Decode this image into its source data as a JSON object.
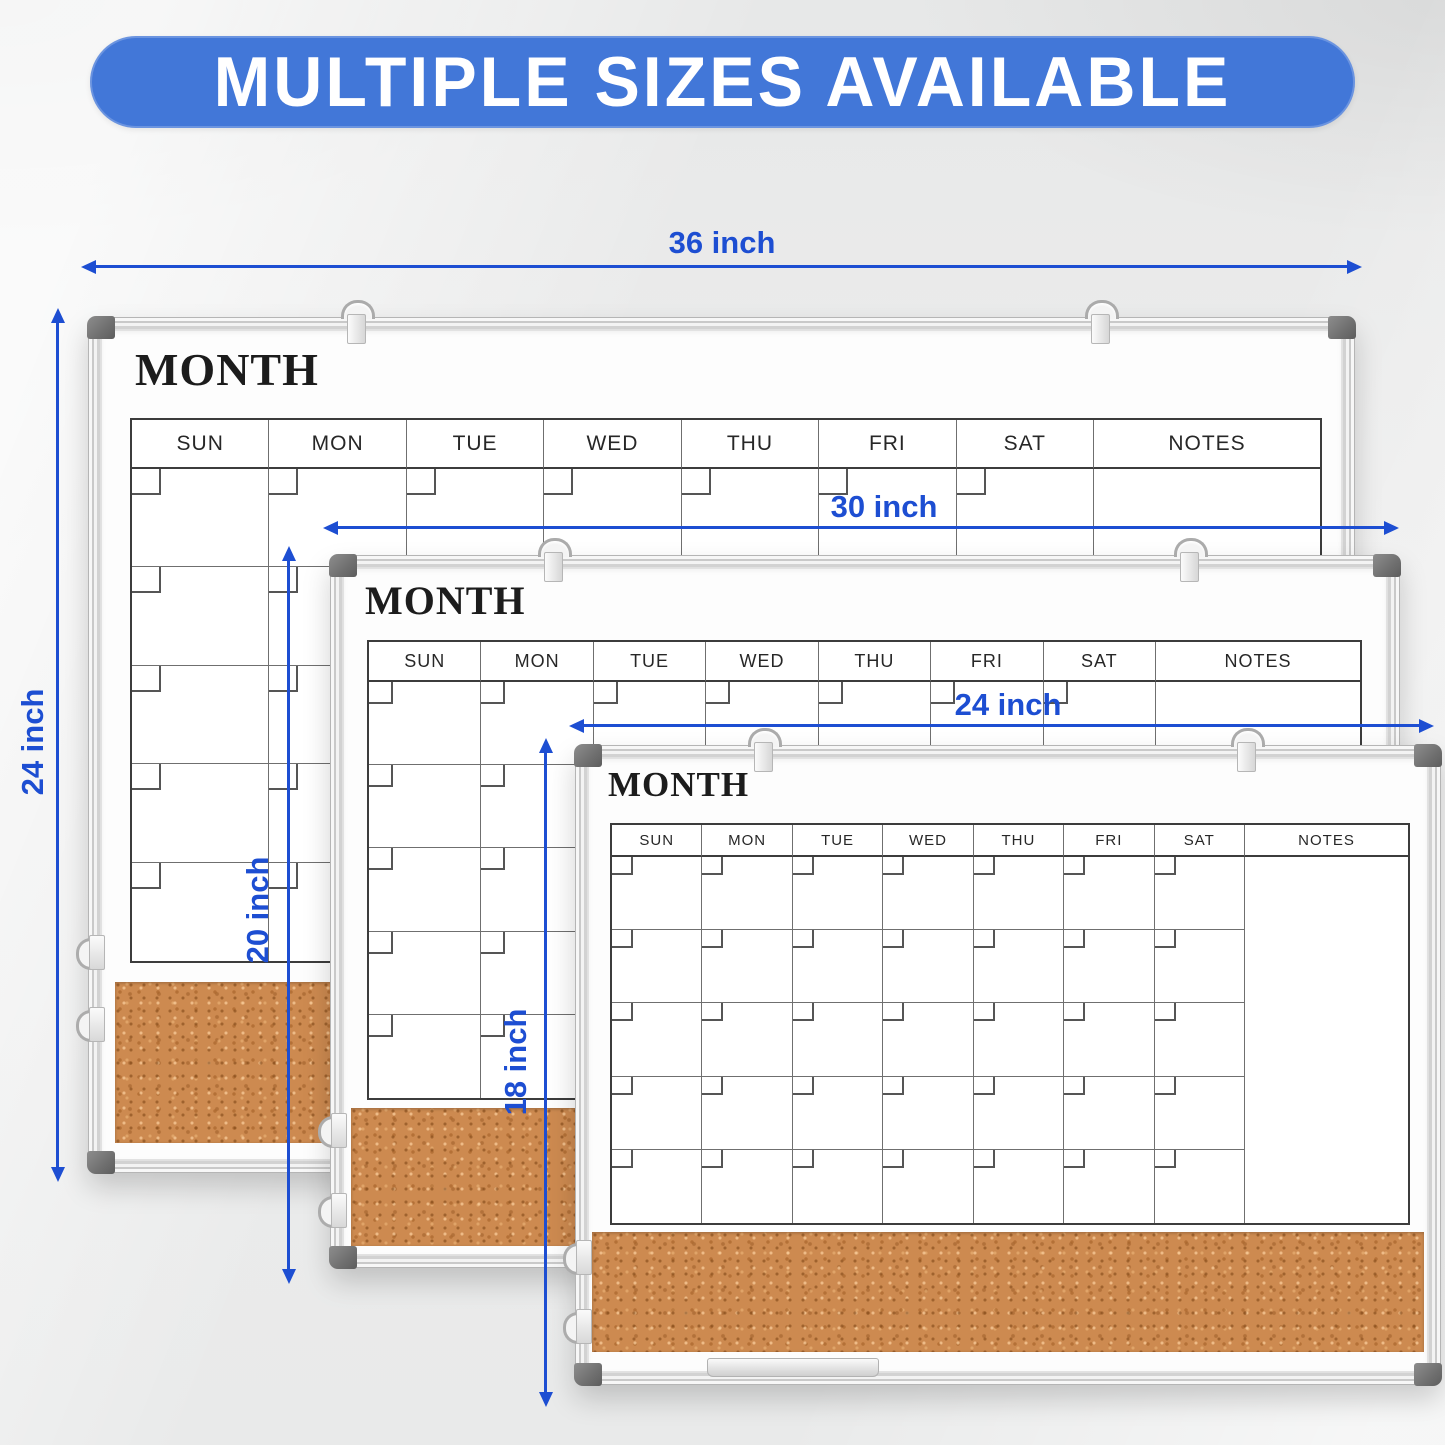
{
  "banner": {
    "text": "MULTIPLE SIZES AVAILABLE",
    "bg_color": "#4277d8",
    "text_color": "#ffffff"
  },
  "calendar": {
    "month_label": "MONTH",
    "days": [
      "SUN",
      "MON",
      "TUE",
      "WED",
      "THU",
      "FRI",
      "SAT"
    ],
    "notes_label": "NOTES",
    "week_rows": 5
  },
  "dimensions": {
    "large": {
      "width_label": "36 inch",
      "height_label": "24 inch"
    },
    "medium": {
      "width_label": "30 inch",
      "height_label": "20 inch"
    },
    "small": {
      "width_label": "24 inch",
      "height_label": "18 inch"
    }
  },
  "colors": {
    "dimension_blue": "#1d4ed2",
    "banner_blue": "#4277d8",
    "cork": "#cd8a50",
    "corner_cap_gray": "#6e6e6e"
  }
}
